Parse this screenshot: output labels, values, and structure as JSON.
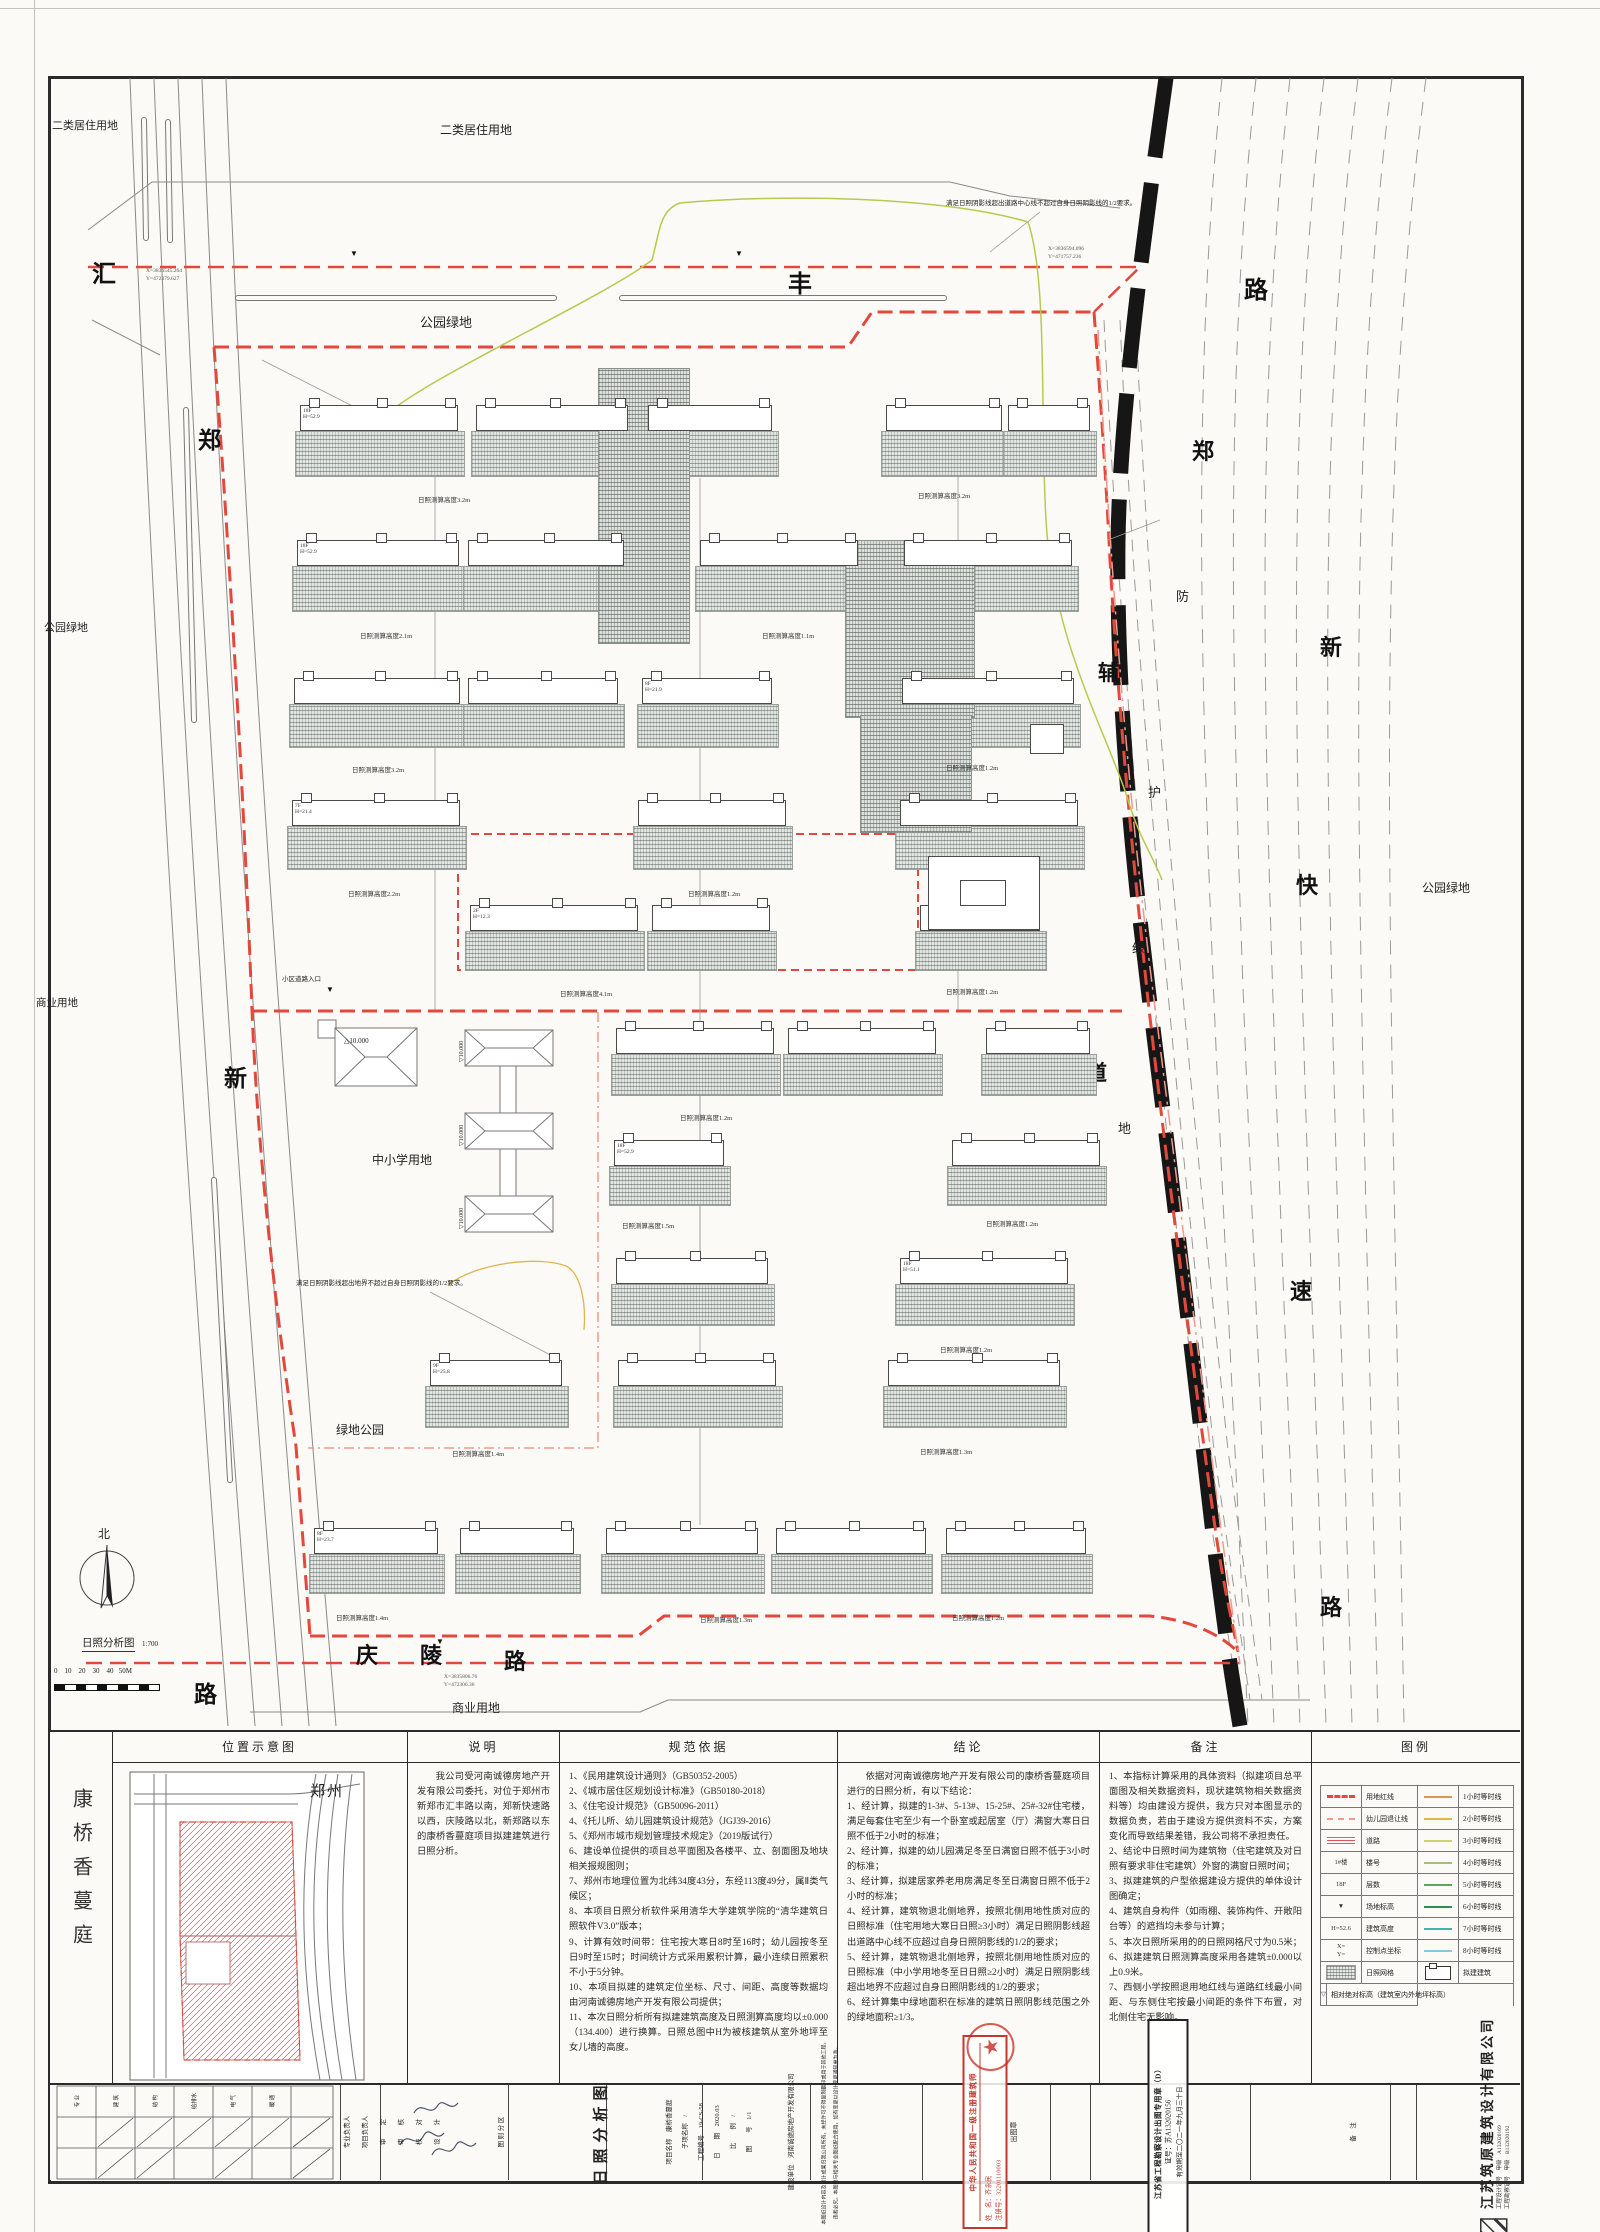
{
  "colors": {
    "red": "#e2493c",
    "lightred": "#f09a8c",
    "green_curve": "#b9c94f",
    "orange": "#d58a3c",
    "teal": "#3fb3a0",
    "rail": "#161616"
  },
  "plan": {
    "labels": [
      {
        "n": "landuse-label",
        "t": "二类居住用地",
        "x": 52,
        "y": 120,
        "s": 11
      },
      {
        "n": "landuse-label",
        "t": "二类居住用地",
        "x": 440,
        "y": 124,
        "s": 12
      },
      {
        "n": "landuse-label",
        "t": "公园绿地",
        "x": 420,
        "y": 316,
        "s": 13
      },
      {
        "n": "landuse-label",
        "t": "公园绿地",
        "x": 44,
        "y": 622,
        "s": 11
      },
      {
        "n": "landuse-label",
        "t": "公园绿地",
        "x": 1422,
        "y": 882,
        "s": 12
      },
      {
        "n": "landuse-label",
        "t": "绿地公园",
        "x": 336,
        "y": 1424,
        "s": 12
      },
      {
        "n": "landuse-label",
        "t": "商业用地",
        "x": 36,
        "y": 998,
        "s": 10.5
      },
      {
        "n": "landuse-label",
        "t": "商业用地",
        "x": 452,
        "y": 1702,
        "s": 12
      },
      {
        "n": "landuse-label",
        "t": "中小学用地",
        "x": 372,
        "y": 1154,
        "s": 12
      },
      {
        "n": "road-name-char",
        "t": "汇",
        "x": 92,
        "y": 262,
        "s": 24,
        "cls": "rd"
      },
      {
        "n": "road-name-char",
        "t": "丰",
        "x": 788,
        "y": 272,
        "s": 24,
        "cls": "rd"
      },
      {
        "n": "road-name-char",
        "t": "路",
        "x": 1244,
        "y": 278,
        "s": 24,
        "cls": "rd"
      },
      {
        "n": "road-name-char",
        "t": "郑",
        "x": 198,
        "y": 428,
        "s": 23,
        "cls": "rd"
      },
      {
        "n": "road-name-char",
        "t": "新",
        "x": 224,
        "y": 1066,
        "s": 23,
        "cls": "rd"
      },
      {
        "n": "road-name-char",
        "t": "路",
        "x": 194,
        "y": 1682,
        "s": 23,
        "cls": "rd"
      },
      {
        "n": "road-name-char",
        "t": "庆",
        "x": 356,
        "y": 1644,
        "s": 22,
        "cls": "rd"
      },
      {
        "n": "road-name-char",
        "t": "陵",
        "x": 420,
        "y": 1644,
        "s": 22,
        "cls": "rd"
      },
      {
        "n": "road-name-char",
        "t": "路",
        "x": 504,
        "y": 1650,
        "s": 22,
        "cls": "rd"
      },
      {
        "n": "road-name-char",
        "t": "郑",
        "x": 1192,
        "y": 440,
        "s": 22,
        "cls": "rd"
      },
      {
        "n": "road-name-char",
        "t": "新",
        "x": 1320,
        "y": 636,
        "s": 22,
        "cls": "rd"
      },
      {
        "n": "road-name-char",
        "t": "快",
        "x": 1296,
        "y": 874,
        "s": 22,
        "cls": "rd"
      },
      {
        "n": "road-name-char",
        "t": "速",
        "x": 1290,
        "y": 1280,
        "s": 22,
        "cls": "rd"
      },
      {
        "n": "road-name-char",
        "t": "路",
        "x": 1320,
        "y": 1596,
        "s": 22,
        "cls": "rd"
      },
      {
        "n": "road-name-char",
        "t": "辅",
        "x": 1098,
        "y": 662,
        "s": 21,
        "cls": "rd"
      },
      {
        "n": "road-name-char",
        "t": "道",
        "x": 1086,
        "y": 1062,
        "s": 21,
        "cls": "rd"
      },
      {
        "n": "greenbelt-char",
        "t": "防",
        "x": 1176,
        "y": 590,
        "s": 13
      },
      {
        "n": "greenbelt-char",
        "t": "护",
        "x": 1148,
        "y": 786,
        "s": 13
      },
      {
        "n": "greenbelt-char",
        "t": "绿",
        "x": 1132,
        "y": 942,
        "s": 13
      },
      {
        "n": "greenbelt-char",
        "t": "地",
        "x": 1118,
        "y": 1122,
        "s": 13
      },
      {
        "n": "shadow-note",
        "t": "满足日照阴影线超出道路中心线不超过自身日照阴影线的1/2要求。",
        "x": 946,
        "y": 200,
        "s": 6.5
      },
      {
        "n": "shadow-note",
        "t": "满足日照阴影线超出地界不超过自身日照阴影线的1/2要求。",
        "x": 296,
        "y": 1280,
        "s": 6.5
      },
      {
        "n": "green-label",
        "t": "集中绿地",
        "x": 878,
        "y": 662,
        "s": 7
      },
      {
        "n": "height-label",
        "t": "日照测算高度6.1m",
        "x": 846,
        "y": 700,
        "s": 6.5
      },
      {
        "n": "facility-label",
        "t": "生活垃圾收集站",
        "x": 990,
        "y": 740,
        "s": 6.5
      },
      {
        "n": "entry-label",
        "t": "小区道路入口",
        "x": 282,
        "y": 976,
        "s": 6.5
      },
      {
        "n": "kindergarten-label",
        "t": "3F  H=10.15",
        "x": 936,
        "y": 864,
        "s": 6
      },
      {
        "n": "corner-marker",
        "t": "▼",
        "x": 350,
        "y": 250,
        "s": 8,
        "cls": "mk"
      },
      {
        "n": "corner-marker",
        "t": "▼",
        "x": 735,
        "y": 250,
        "s": 8,
        "cls": "mk"
      },
      {
        "n": "corner-marker",
        "t": "▼",
        "x": 436,
        "y": 1638,
        "s": 8,
        "cls": "mk"
      },
      {
        "n": "corner-marker",
        "t": "▼",
        "x": 326,
        "y": 986,
        "s": 8,
        "cls": "mk"
      },
      {
        "n": "coord-label",
        "t": "X=3836545.264",
        "x": 146,
        "y": 268,
        "s": 5.5,
        "cls": "co"
      },
      {
        "n": "coord-label",
        "t": "Y=472379.627",
        "x": 146,
        "y": 276,
        "s": 5.5,
        "cls": "co"
      },
      {
        "n": "coord-label",
        "t": "X=3836594.096",
        "x": 1048,
        "y": 246,
        "s": 5.5,
        "cls": "co"
      },
      {
        "n": "coord-label",
        "t": "Y=471757.236",
        "x": 1048,
        "y": 254,
        "s": 5.5,
        "cls": "co"
      },
      {
        "n": "coord-label",
        "t": "X=3835806.76",
        "x": 444,
        "y": 1674,
        "s": 5.5,
        "cls": "co"
      },
      {
        "n": "coord-label",
        "t": "Y=472306.36",
        "x": 444,
        "y": 1682,
        "s": 5.5,
        "cls": "co"
      },
      {
        "n": "north-label",
        "t": "北",
        "x": 98,
        "y": 1528,
        "s": 12
      },
      {
        "n": "map-title",
        "t": "日照分析图",
        "x": 82,
        "y": 1638,
        "s": 10.5,
        "cls": "ul"
      },
      {
        "n": "map-scale",
        "t": "1:700",
        "x": 142,
        "y": 1641,
        "s": 7
      },
      {
        "n": "scale-numbers",
        "t": "0    10    20    30    40   50M",
        "x": 54,
        "y": 1668,
        "s": 7
      },
      {
        "n": "level-label",
        "t": "△10.000",
        "x": 344,
        "y": 1038,
        "s": 7
      },
      {
        "n": "level-label",
        "t": "▽10.000",
        "x": 459,
        "y": 1062,
        "s": 6,
        "cls": "v"
      },
      {
        "n": "level-label",
        "t": "▽10.000",
        "x": 459,
        "y": 1146,
        "s": 6,
        "cls": "v"
      },
      {
        "n": "level-label",
        "t": "▽10.000",
        "x": 459,
        "y": 1229,
        "s": 6,
        "cls": "v"
      }
    ],
    "rows": [
      {
        "y": 405,
        "sh": 46,
        "c": [
          [
            300,
            158,
            "18F\nH=52.9"
          ],
          [
            476,
            152
          ],
          [
            648,
            124
          ],
          [
            886,
            116
          ],
          [
            1008,
            82
          ]
        ],
        "labels": [
          [
            418,
            494,
            "日照测算高度3.2m"
          ],
          [
            918,
            490,
            "日照测算高度3.2m"
          ]
        ]
      },
      {
        "y": 540,
        "sh": 46,
        "c": [
          [
            297,
            162,
            "18F\nH=52.9"
          ],
          [
            468,
            156
          ],
          [
            700,
            158
          ],
          [
            904,
            168
          ]
        ],
        "labels": [
          [
            360,
            630,
            "日照测算高度2.1m"
          ],
          [
            762,
            630,
            "日照测算高度1.1m"
          ]
        ]
      },
      {
        "y": 678,
        "sh": 44,
        "c": [
          [
            294,
            166
          ],
          [
            468,
            150
          ],
          [
            642,
            130,
            "8F\nH=21.9"
          ],
          [
            902,
            172
          ]
        ],
        "labels": [
          [
            352,
            764,
            "日照测算高度3.2m"
          ],
          [
            946,
            762,
            "日照测算高度1.2m"
          ]
        ]
      },
      {
        "y": 800,
        "sh": 44,
        "c": [
          [
            292,
            168,
            "7F\nH=21.4"
          ],
          [
            638,
            148
          ],
          [
            900,
            178
          ]
        ],
        "labels": [
          [
            348,
            888,
            "日照测算高度2.2m"
          ],
          [
            688,
            888,
            "日照测算高度1.2m"
          ]
        ]
      },
      {
        "y": 905,
        "sh": 40,
        "c": [
          [
            470,
            168,
            "2F\nH=12.3"
          ],
          [
            652,
            118
          ],
          [
            920,
            120
          ]
        ],
        "labels": [
          [
            560,
            988,
            "日照测算高度4.1m"
          ],
          [
            946,
            986,
            "日照测算高度1.2m"
          ]
        ]
      },
      {
        "y": 1028,
        "sh": 42,
        "c": [
          [
            616,
            158
          ],
          [
            788,
            148
          ],
          [
            986,
            104
          ]
        ],
        "labels": [
          [
            680,
            1112,
            "日照测算高度1.2m"
          ]
        ]
      },
      {
        "y": 1140,
        "sh": 40,
        "c": [
          [
            614,
            110,
            "18F\nH=52.9"
          ],
          [
            952,
            148
          ]
        ],
        "labels": [
          [
            622,
            1220,
            "日照测算高度1.5m"
          ],
          [
            986,
            1218,
            "日照测算高度1.2m"
          ]
        ]
      },
      {
        "y": 1258,
        "sh": 42,
        "c": [
          [
            616,
            152
          ],
          [
            900,
            168,
            "18F\nH=51.1"
          ]
        ],
        "labels": [
          [
            940,
            1344,
            "日照测算高度1.2m"
          ]
        ]
      },
      {
        "y": 1360,
        "sh": 42,
        "c": [
          [
            430,
            132,
            "9F\nH=25.8"
          ],
          [
            618,
            158
          ],
          [
            888,
            172
          ]
        ],
        "labels": [
          [
            452,
            1448,
            "日照测算高度1.4m"
          ],
          [
            920,
            1446,
            "日照测算高度1.3m"
          ]
        ]
      },
      {
        "y": 1528,
        "sh": 40,
        "c": [
          [
            314,
            124,
            "8F\nH=23.7"
          ],
          [
            460,
            114
          ],
          [
            606,
            152
          ],
          [
            776,
            150
          ],
          [
            946,
            140
          ]
        ],
        "labels": [
          [
            336,
            1612,
            "日照测算高度1.4m"
          ],
          [
            700,
            1614,
            "日照测算高度1.3m"
          ],
          [
            952,
            1612,
            "日照测算高度1.2m"
          ]
        ]
      }
    ],
    "hatches": [
      [
        598,
        368,
        92,
        276
      ],
      [
        845,
        540,
        130,
        178
      ],
      [
        860,
        715,
        112,
        118
      ]
    ],
    "whites": [
      [
        928,
        856,
        112,
        74
      ],
      [
        960,
        880,
        46,
        26
      ],
      [
        1030,
        724,
        34,
        30
      ]
    ]
  },
  "panel": {
    "project": "康桥香蔓庭",
    "loc": {
      "title": "位置示意图",
      "city": "郑州"
    },
    "desc": {
      "title": "说明",
      "body": "我公司受河南诚德房地产开发有限公司委托，对位于郑州市新郑市汇丰路以南，郑新快速路以西，庆陵路以北，新郑路以东的康桥香蔓庭项目拟建建筑进行日照分析。"
    },
    "code": {
      "title": "规范依据",
      "items": [
        "1、《民用建筑设计通则》（GB50352-2005）",
        "2、《城市居住区规划设计标准》（GB50180-2018）",
        "3、《住宅设计规范》（GB50096-2011）",
        "4、《托儿所、幼儿园建筑设计规范》（JGJ39-2016）",
        "5、《郑州市城市规划管理技术规定》（2019版试行）",
        "6、建设单位提供的项目总平面图及各楼平、立、剖面图及地块相关报规图则；",
        "7、郑州市地理位置为北纬34度43分，东经113度49分，属Ⅱ类气候区；",
        "8、本项目日照分析软件采用清华大学建筑学院的“清华建筑日照软件V3.0”版本；",
        "9、计算有效时间带：住宅按大寒日8时至16时；幼儿园按冬至日9时至15时；时间统计方式采用累积计算，最小连续日照累积不小于5分钟。",
        "10、本项目拟建的建筑定位坐标、尺寸、间距、高度等数据均由河南诚德房地产开发有限公司提供；",
        "11、本次日照分析所有拟建建筑高度及日照测算高度均以±0.000（134.400）进行换算。日照总图中H为被核建筑从室外地坪至女儿墙的高度。"
      ]
    },
    "concl": {
      "title": "结论",
      "intro": "依据对河南诚德房地产开发有限公司的康桥香蔓庭项目进行的日照分析，有以下结论：",
      "items": [
        "1、经计算，拟建的1-3#、5-13#、15-25#、25#-32#住宅楼，满足每套住宅至少有一个卧室或起居室（厅）满窗大寒日日照不低于2小时的标准；",
        "2、经计算，拟建的幼儿园满足冬至日满窗日照不低于3小时的标准；",
        "3、经计算，拟建居家养老用房满足冬至日满窗日照不低于2小时的标准；",
        "4、经计算，建筑物退北侧地界，按照北侧用地性质对应的日照标准（住宅用地大寒日日照≥3小时）满足日照阴影线超出道路中心线不应超过自身日照阴影线的1/2的要求；",
        "5、经计算，建筑物退北侧地界，按照北侧用地性质对应的日照标准（中小学用地冬至日日照≥2小时）满足日照阴影线超出地界不应超过自身日照阴影线的1/2的要求；",
        "6、经计算集中绿地面积在标准的建筑日照阴影线范围之外的绿地面积≥1/3。"
      ]
    },
    "notes": {
      "title": "备注",
      "items": [
        "1、本指标计算采用的具体资料（拟建项目总平面图及相关数据资料，现状建筑物相关数据资料等）均由建设方提供，我方只对本图显示的数据负责，若由于建设方提供资料不实，方案变化而导致结果差错，我公司将不承担责任。",
        "2、结论中日照时间为建筑物（住宅建筑及对日照有要求非住宅建筑）外窗的满窗日照时间；",
        "3、拟建建筑的户型依据建设方提供的单体设计图确定；",
        "4、建筑自身构件（如雨棚、装饰构件、开敞阳台等）的遮挡均未参与计算；",
        "5、本次日照所采用的的日照网格尺寸为0.5米；",
        "6、拟建建筑日照测算高度采用各建筑±0.000以上0.9米。",
        "7、西侧小学按照退用地红线与道路红线最小间距、与东侧住宅按最小间距的条件下布置，对北侧住宅无影响。"
      ]
    },
    "legend": {
      "title": "图例",
      "left": [
        {
          "sym": "red",
          "label": "用地红线"
        },
        {
          "sym": "pink",
          "label": "幼儿园退让线"
        },
        {
          "sym": "road",
          "label": "道路"
        },
        {
          "sym": "txt",
          "t": "1#楼",
          "label": "楼号"
        },
        {
          "sym": "txt",
          "t": "18F",
          "label": "层数"
        },
        {
          "sym": "txt",
          "t": "▼",
          "label": "场地标高"
        },
        {
          "sym": "txt",
          "t": "H=52.6",
          "label": "建筑高度"
        },
        {
          "sym": "txt",
          "t": "X=\nY=",
          "label": "控制点坐标"
        },
        {
          "sym": "grid",
          "label": "日照网格"
        },
        {
          "sym": "txt",
          "t": "▽",
          "label": "相对绝对标高（建筑室内外地坪标高）"
        }
      ],
      "right": [
        {
          "color": "#e2934e",
          "label": "1小时等时线"
        },
        {
          "color": "#ddb84e",
          "label": "2小时等时线"
        },
        {
          "color": "#cfd06e",
          "label": "3小时等时线"
        },
        {
          "color": "#9fbf7a",
          "label": "4小时等时线"
        },
        {
          "color": "#5aa85e",
          "label": "5小时等时线"
        },
        {
          "color": "#2f8f52",
          "label": "6小时等时线"
        },
        {
          "color": "#43b3a4",
          "label": "7小时等时线"
        },
        {
          "color": "#8cc8dd",
          "label": "8小时等时线"
        },
        {
          "sym": "bld",
          "label": "拟建建筑"
        }
      ]
    }
  },
  "titleblock": {
    "sig_cols": [
      "专 业",
      "建 筑",
      "结 构",
      "给排水",
      "电 气",
      "暖 通"
    ],
    "items": [
      {
        "t": "专业负责人",
        "x": 346,
        "y": 2130,
        "s": 6.5
      },
      {
        "t": "项目负责人",
        "x": 364,
        "y": 2130,
        "s": 6.5
      },
      {
        "t": "审　　定",
        "x": 382,
        "y": 2130,
        "s": 6.5
      },
      {
        "t": "审　　核",
        "x": 400,
        "y": 2130,
        "s": 6.5
      },
      {
        "t": "校　　对",
        "x": 418,
        "y": 2130,
        "s": 6.5
      },
      {
        "t": "设　　计",
        "x": 436,
        "y": 2130,
        "s": 6.5
      },
      {
        "t": "图 则 分 区",
        "x": 500,
        "y": 2130,
        "s": 6.5
      },
      {
        "t": "日照分析图",
        "x": 600,
        "y": 2130,
        "s": 15,
        "ls": 6,
        "b": 1
      },
      {
        "t": "项目名称　康桥香蔓庭",
        "x": 668,
        "y": 2130,
        "s": 6.5
      },
      {
        "t": "子项名称　/",
        "x": 684,
        "y": 2130,
        "s": 6.5
      },
      {
        "t": "工程编号　19-CS-58",
        "x": 700,
        "y": 2130,
        "s": 6.5
      },
      {
        "t": "日　　期　2020.03",
        "x": 716,
        "y": 2130,
        "s": 6.5
      },
      {
        "t": "比　　例　/",
        "x": 732,
        "y": 2130,
        "s": 6.5
      },
      {
        "t": "图　　号　1/1",
        "x": 748,
        "y": 2130,
        "s": 6.5
      },
      {
        "t": "建设单位　河南诚德房地产开发有限公司",
        "x": 790,
        "y": 2130,
        "s": 6.5
      },
      {
        "t": "本图纸设计内容及设计成果归我公司所有，未经许可不得复制翻印或用于其他工程，",
        "x": 824,
        "y": 2130,
        "s": 5
      },
      {
        "t": "违者必究。本图须与相关专业图纸配合使用，如有变更以设计变更通知单为准。",
        "x": 836,
        "y": 2130,
        "s": 5
      },
      {
        "t": "出图章",
        "x": 1014,
        "y": 2130,
        "s": 7
      },
      {
        "t": "备　注",
        "x": 1352,
        "y": 2130,
        "s": 6.5
      }
    ],
    "stamp_red": {
      "l1": "中华人民共和国一级注册建筑师",
      "l2": "姓　名：齐永民",
      "l3": "注册号：32201110003"
    },
    "stamp_black": {
      "l1": "江苏省工程勘察设计出图专用章（D）",
      "l2": "证号：苏A132020156",
      "l3": "有效期至二〇二一年九月三十日"
    },
    "company": {
      "name": "江苏筑原建筑设计有限公司",
      "cert1": "工程设计证号　甲级　A132020169",
      "cert2": "工程勘察证号　甲级　B132020192"
    }
  }
}
